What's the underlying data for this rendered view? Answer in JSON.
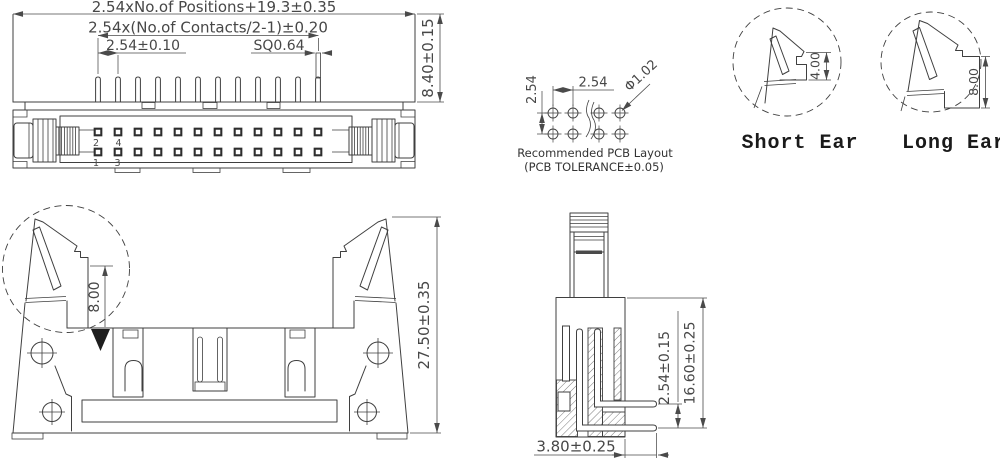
{
  "views": {
    "top_view": {
      "dims": {
        "overall": "2.54xNo.of Positions+19.3±0.35",
        "contacts_span": "2.54x(No.of Contacts/2-1)±0.20",
        "pitch": "2.54±0.10",
        "pin_square": "SQ0.64",
        "body_height": "8.40±0.15"
      },
      "pin_numbers": {
        "pin2": "2",
        "pin4": "4",
        "pin1": "1",
        "pin3": "3"
      }
    },
    "pcb_layout": {
      "dims": {
        "row_pitch": "2.54",
        "col_pitch": "2.54",
        "hole_dia": "Φ1.02"
      },
      "caption_line1": "Recommended PCB Layout",
      "caption_line2": "(PCB TOLERANCE±0.05)"
    },
    "ear_details": {
      "short": {
        "label": "Short Ear",
        "dim": "4.00"
      },
      "long": {
        "label": "Long Ear",
        "dim": "8.00"
      }
    },
    "front_view": {
      "dims": {
        "ear_height": "8.00",
        "overall_height": "27.50±0.35"
      }
    },
    "side_view": {
      "dims": {
        "row_pitch": "2.54±0.15",
        "overall_height": "16.60±0.25",
        "pin_protrusion": "3.80±0.25"
      }
    },
    "colors": {
      "line": "#3f3f3f",
      "text": "#474747",
      "label": "#1a1a1a"
    }
  }
}
